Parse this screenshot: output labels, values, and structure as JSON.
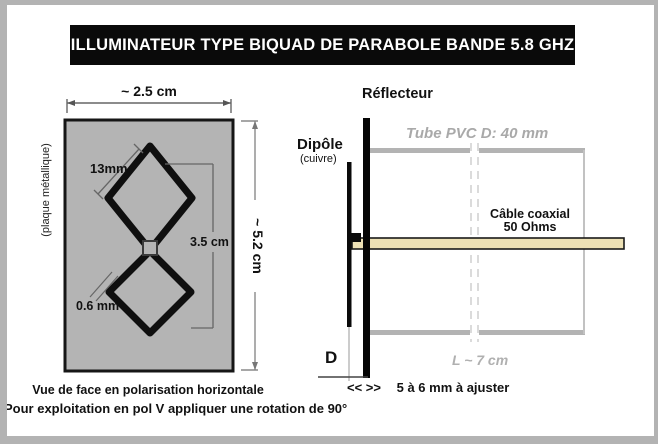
{
  "title": {
    "text": "ILLUMINATEUR TYPE BIQUAD DE PARABOLE BANDE 5.8 GHZ",
    "bg": "#0a0a0a",
    "fg": "#ffffff"
  },
  "biquad_view": {
    "width_label": "~ 2.5 cm",
    "height_label": "~ 5.2 cm",
    "plate_label": "(plaque métallique)",
    "quad_side_label": "13mm",
    "loops_height_label": "3.5 cm",
    "wire_diameter_label": "0.6 mm",
    "plate_color": "#b4b4b4",
    "wire_color": "#0f0f0f",
    "caption_line1": "Vue de face en polarisation horizontale",
    "caption_line2": "Pour exploitation en pol V appliquer une rotation de 90°"
  },
  "side_view": {
    "reflector_label": "Réflecteur",
    "dipole_label": "Dipôle",
    "dipole_sublabel": "(cuivre)",
    "tube_label": "Tube PVC D: 40 mm",
    "tube_color": "#b3b3b3",
    "cable_label_line1": "Câble coaxial",
    "cable_label_line2": "50 Ohms",
    "cable_color": "#ede1b5",
    "length_label": "L ~ 7 cm",
    "distance_letter": "D",
    "adjust_marker": "<< >>",
    "adjust_label": "5 à 6 mm à ajuster"
  }
}
